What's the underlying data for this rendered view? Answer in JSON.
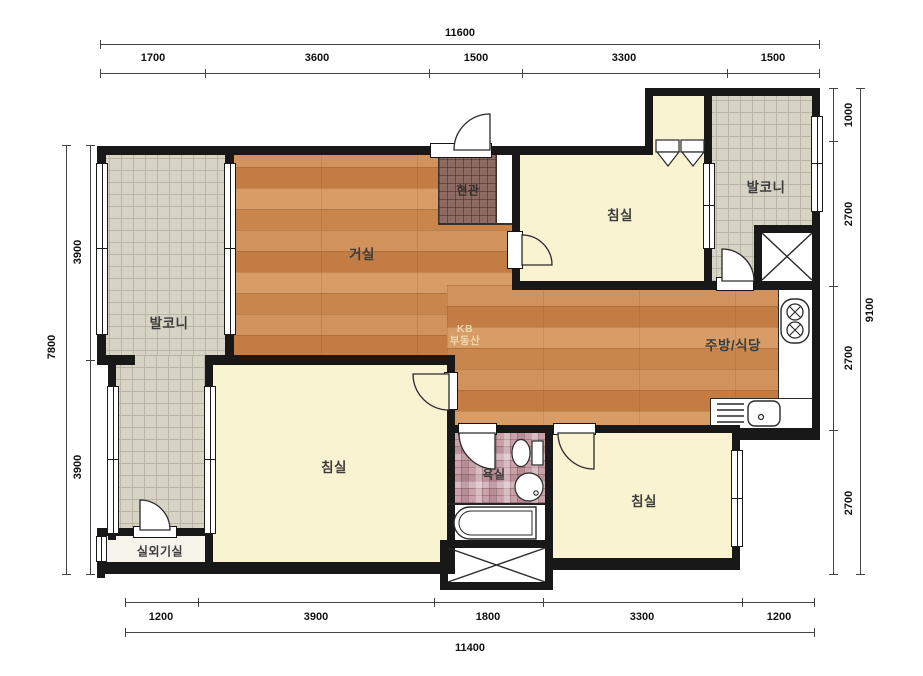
{
  "title": "apartment-floorplan",
  "watermark": {
    "line1": "KB",
    "line2": "부동산"
  },
  "rooms": {
    "living": "거실",
    "entrance": "현관",
    "bedroom_top": "침실",
    "bedroom_left": "침실",
    "bedroom_right": "침실",
    "balcony_left": "발코니",
    "balcony_right": "발코니",
    "kitchen": "주방/식당",
    "bathroom": "욕실",
    "outdoor_unit": "실외기실"
  },
  "dims": {
    "top": {
      "total": "11600",
      "segments": [
        "1700",
        "3600",
        "1500",
        "3300",
        "1500"
      ]
    },
    "bottom": {
      "total": "11400",
      "segments": [
        "1200",
        "3900",
        "1800",
        "3300",
        "1200"
      ]
    },
    "left": {
      "total": "7800",
      "segments": [
        "3900",
        "3900"
      ]
    },
    "right": {
      "total": "9100",
      "segments": [
        "1000",
        "2700",
        "2700",
        "2700"
      ]
    }
  },
  "colors": {
    "wall": "#181818",
    "wood_floor": "#cd8a4e",
    "balcony_tile": "#d7d4c5",
    "entrance_tile": "#8e6c63",
    "bathroom_tile": "#c8a2a8",
    "room_cream": "#faf3d1",
    "watermark": "#efe0ba"
  }
}
